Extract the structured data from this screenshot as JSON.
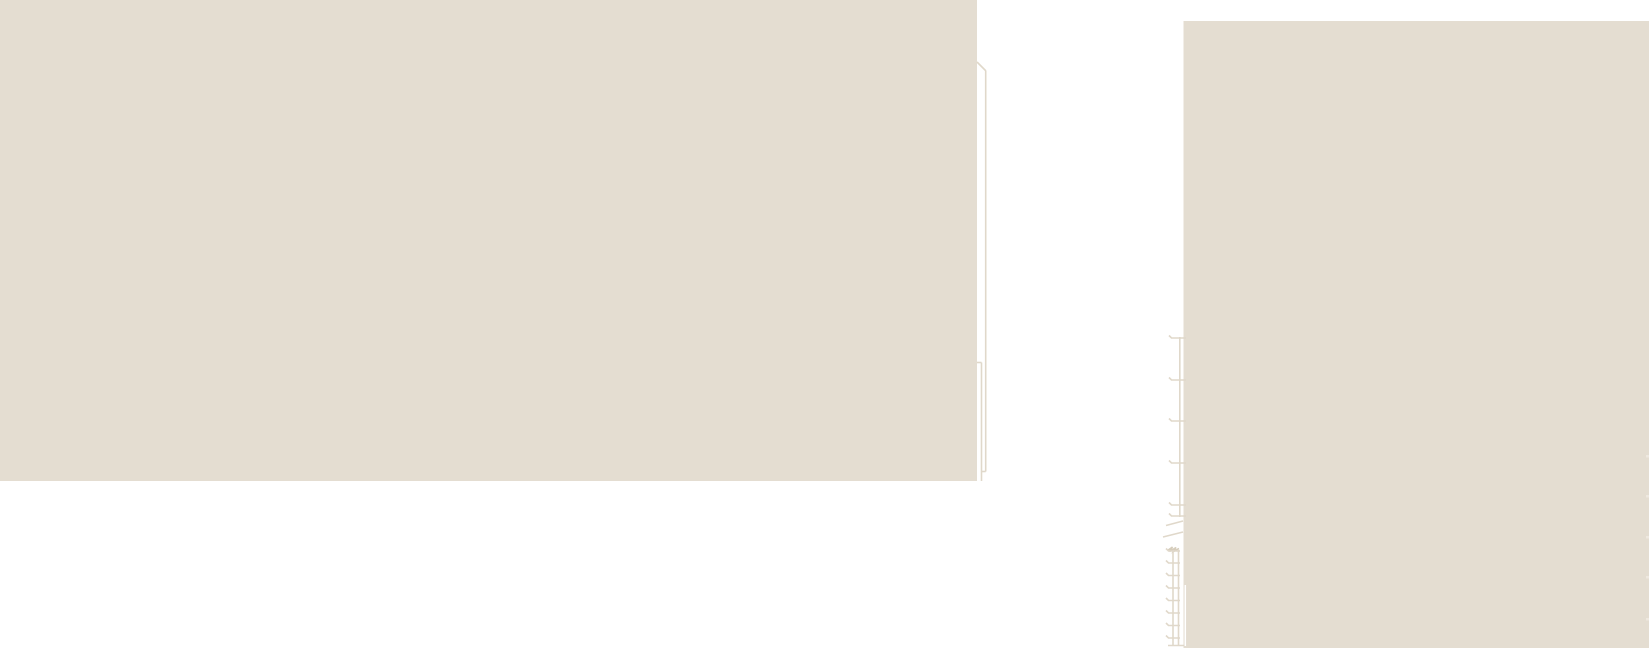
{
  "canvas": {
    "width": 1649,
    "height": 648
  },
  "colors": {
    "background": "#ffffff",
    "mass_fill": "#e4ddd1",
    "line": "#e0d8ca",
    "line_strong": "#d6cdbc",
    "edge_tick": "#eee8df",
    "white": "#ffffff"
  },
  "drawing": {
    "left_mass": {
      "x": 0,
      "y": 0,
      "width": 977,
      "height": 481
    },
    "right_mass": {
      "x": 1183.5,
      "y": 21,
      "width": 465.5,
      "height": 627
    },
    "tick_line": {
      "x": 1179.8,
      "y_top": 337,
      "y_bottom": 517,
      "tick_ys": [
        338,
        380,
        421,
        463,
        505,
        516
      ],
      "tick_x_left": 1171.5,
      "tick_x_right": 1186
    },
    "ladder": {
      "left_rail_x": 1173,
      "right_rail_x": 1178.5,
      "y_top": 551,
      "y_bottom": 645,
      "rung_ys": [
        551,
        563,
        575.5,
        588,
        600.5,
        613,
        625.5,
        638
      ],
      "rung_x_left": 1168.5
    },
    "edge_ticks": {
      "x": 1646,
      "width": 3,
      "height": 2.5,
      "ys": [
        455,
        495,
        536,
        576,
        618
      ]
    }
  }
}
